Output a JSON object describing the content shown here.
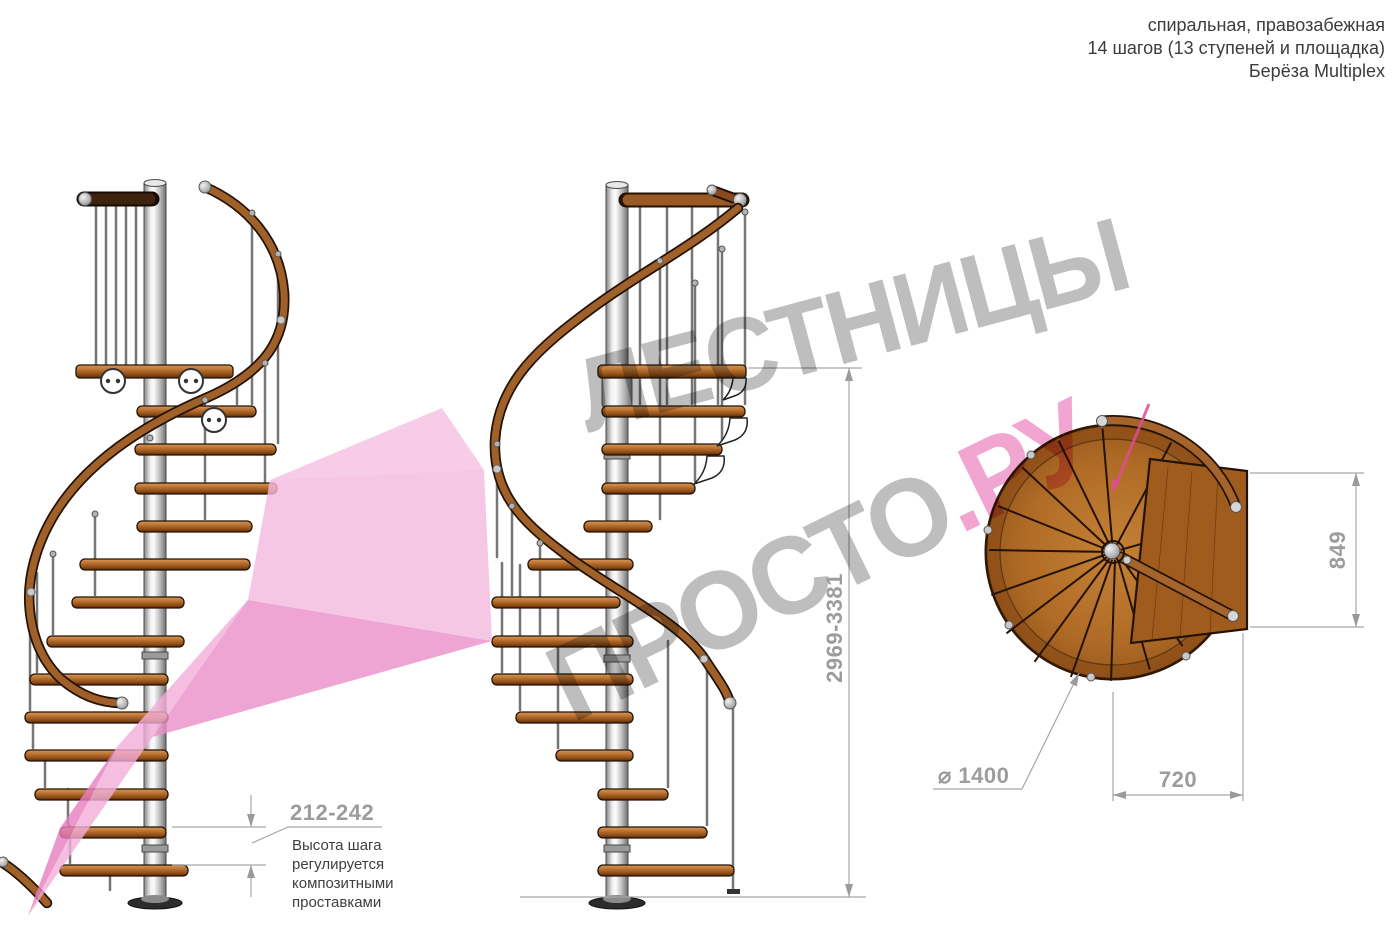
{
  "header": {
    "line1": "спиральная, правозабежная",
    "line2": "14 шагов (13 ступеней и площадка)",
    "line3": "Берёза Multiplex"
  },
  "dimensions": {
    "total_height": "2969-3381",
    "step_height": "212-242",
    "diameter": "⌀ 1400",
    "platform_width": "720",
    "platform_depth": "849"
  },
  "note_lines": [
    "Высота шага",
    "регулируется",
    "композитными",
    "проставками"
  ],
  "watermark": {
    "line1": "ЛЕСТНИЦЫ",
    "line2_gray": "ПРОСТО",
    "line2_pink": ".РУ",
    "gray_color": "#b9b9b9",
    "pink_color": "#f09fce",
    "arrow_pink": "#f3aed9"
  },
  "colors": {
    "wood": "#b5722c",
    "rail": "#a0602a",
    "pole": "#d9d9d9",
    "dim_lines": "#a6a6a6",
    "dim_text": "#9c9c9c",
    "note_text": "#3f3f3f"
  }
}
